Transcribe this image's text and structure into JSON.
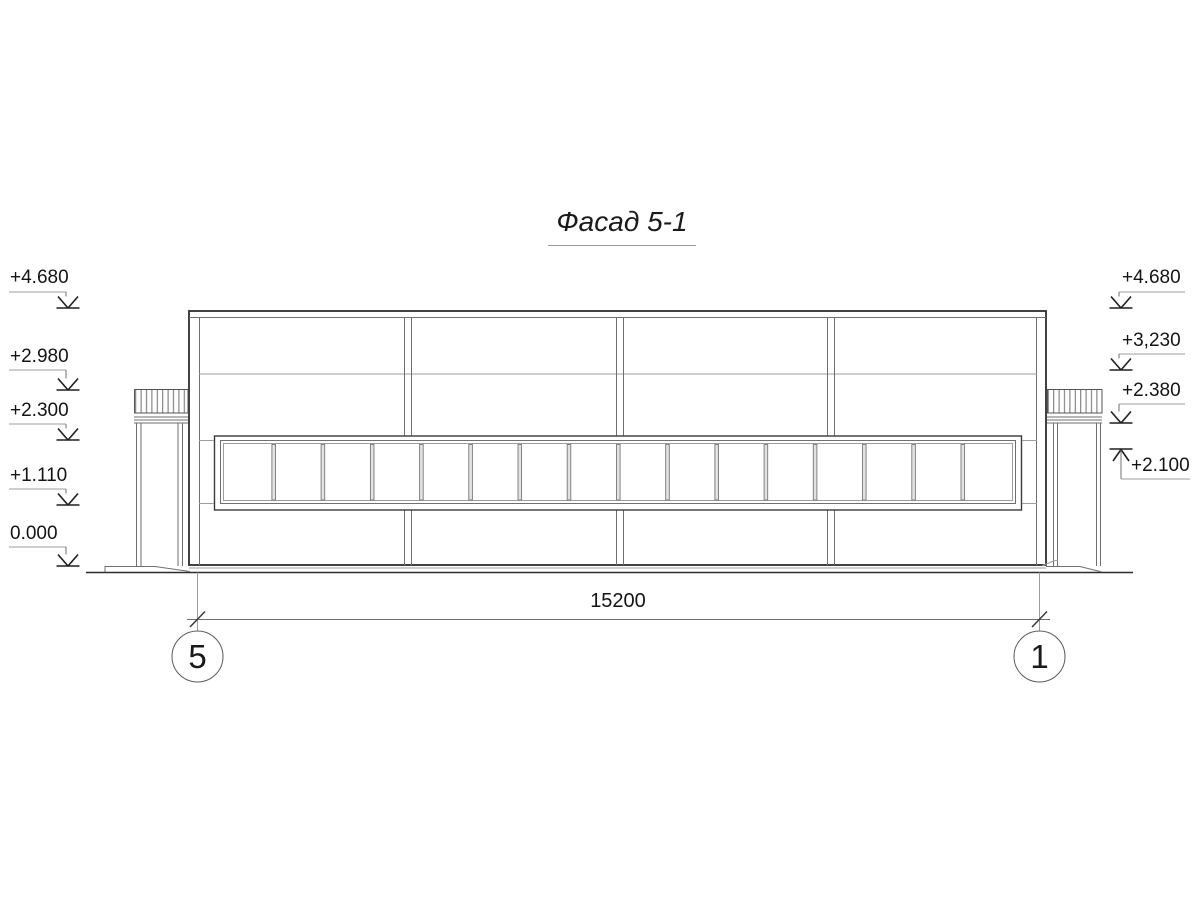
{
  "title": {
    "text": "Фасад 5-1"
  },
  "elevations": {
    "left": [
      {
        "label": "+4.680"
      },
      {
        "label": "+2.980"
      },
      {
        "label": "+2.300"
      },
      {
        "label": "+1.110"
      },
      {
        "label": "0.000"
      }
    ],
    "right": [
      {
        "label": "+4.680"
      },
      {
        "label": "+3,230"
      },
      {
        "label": "+2.380"
      },
      {
        "label": "+2.100"
      }
    ]
  },
  "dimension": {
    "label": "15200"
  },
  "axes": {
    "left": {
      "label": "5"
    },
    "right": {
      "label": "1"
    }
  },
  "window_band": {
    "pane_count": 16
  },
  "colors": {
    "background": "#ffffff",
    "line_heavy": "#2d2d2d",
    "line_thin": "#6f6f6f",
    "text": "#141414"
  }
}
